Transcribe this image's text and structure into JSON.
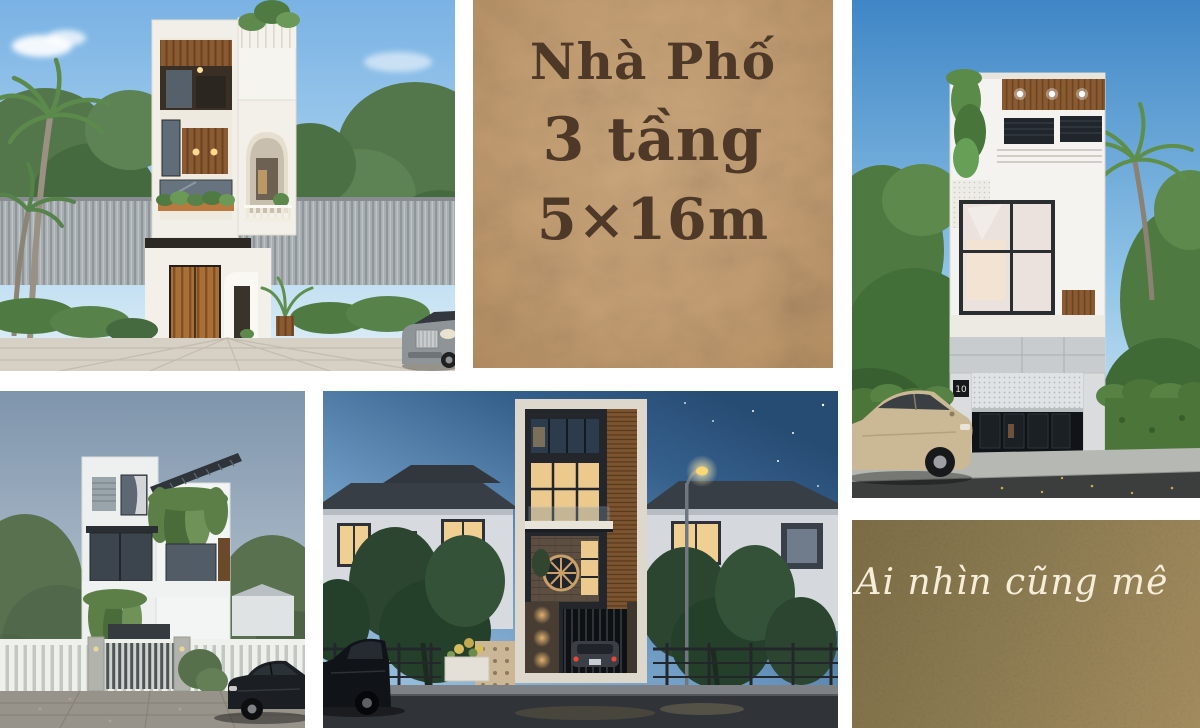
{
  "page": {
    "width": 1200,
    "height": 728,
    "background": "#ffffff"
  },
  "title_panel": {
    "background": "#c49e73",
    "text_color": "#4e3827",
    "line1": "Nhà Phố",
    "line2": "3 tầng",
    "line3": "5×16m"
  },
  "caption_panel": {
    "background": "#8d7c52",
    "text_color": "#f6eed9",
    "text": "Ai nhìn cũng mê"
  },
  "photos": {
    "top_left": {
      "alt": "Front render of a modern 3-storey white townhouse with wood slat accents, arched balcony tower, rooftop plants, palm trees, corrugated fence and a silver car"
    },
    "top_right": {
      "alt": "Narrow 3-storey townhouse render with wood soffit, cascading plants, half-open perforated garage shutter, green hedges, palm fronds and a beige sedan parked on the street",
      "house_number": "10"
    },
    "bottom_left": {
      "alt": "White 3-storey townhouse render with slanted roof louvers, vines spilling over balconies, white picket fence, slatted gate and a black car in the driveway"
    },
    "bottom_center": {
      "alt": "Dusk render of a tall 3-storey townhouse with warm lit windows and wood screen, between two neighbouring houses, glowing street lamp, trees and a parked dark car"
    }
  }
}
